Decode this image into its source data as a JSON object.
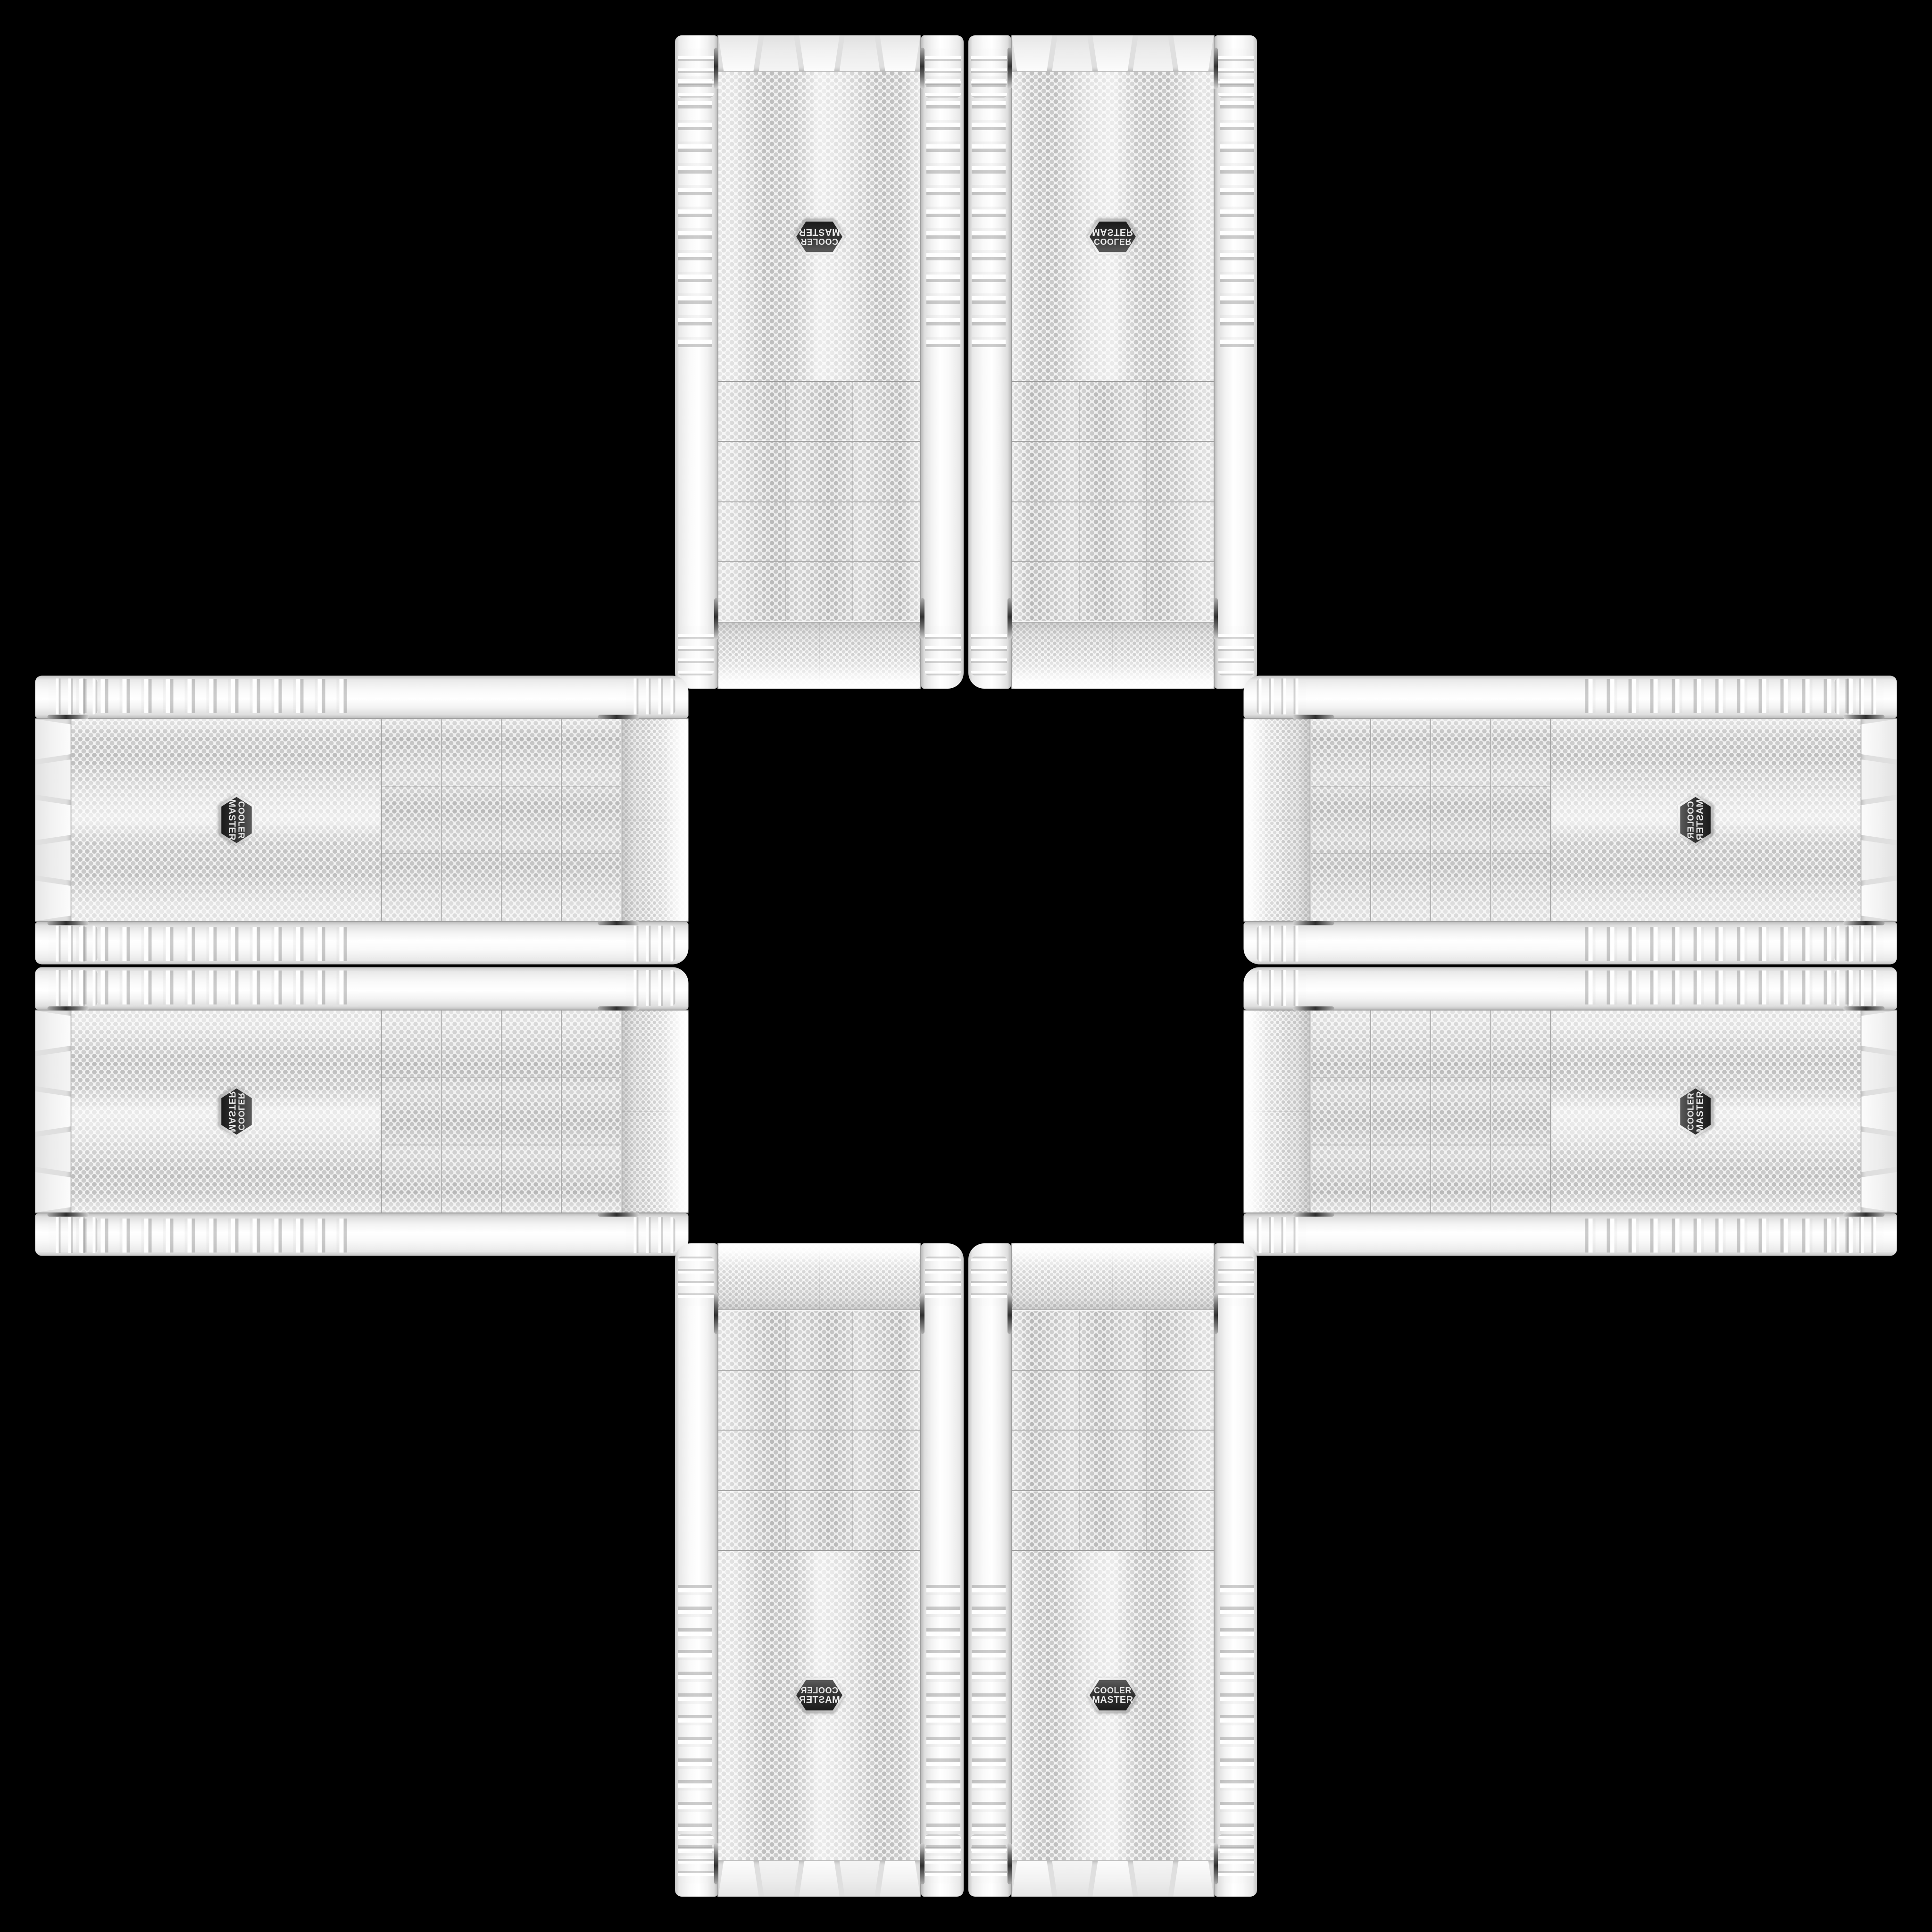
{
  "scene": {
    "background_color": "#000000",
    "description": "Eight white Cooler Master PC case front panels arranged in a plus / cross pattern on a black background",
    "arrangement": "two vertical cases on top, two on bottom, two horizontal cases on the left, two on the right, all mirror copies of one product photo"
  },
  "badge": {
    "line1": "COOLER",
    "line2": "MASTER",
    "face_color": "#2e2e2e",
    "ring_color": "#d6d6d6",
    "text_color": "#e8e8e8"
  },
  "palette": {
    "case_white": "#f4f4f4",
    "mesh_background": "#f1f1f1",
    "mesh_dot": "#c0c0c0",
    "bay_dot": "#b7b7b7",
    "seam_gray": "#a5a5a5",
    "chrome_accent": "#4f4f4f",
    "background": "#000000"
  },
  "tiles": [
    {
      "id": "top-left",
      "orientation": "vertical",
      "flip": "rotated 180°"
    },
    {
      "id": "top-right",
      "orientation": "vertical",
      "flip": "flipped vertically"
    },
    {
      "id": "left-top",
      "orientation": "horizontal",
      "flip": "rotated 90° cw"
    },
    {
      "id": "right-top",
      "orientation": "horizontal",
      "flip": "rotated 90° ccw + flipped"
    },
    {
      "id": "left-bottom",
      "orientation": "horizontal",
      "flip": "rotated 90° cw + flipped"
    },
    {
      "id": "right-bottom",
      "orientation": "horizontal",
      "flip": "rotated 90° ccw"
    },
    {
      "id": "bottom-left",
      "orientation": "vertical",
      "flip": "flipped horizontally"
    },
    {
      "id": "bottom-right",
      "orientation": "vertical",
      "flip": "none"
    }
  ]
}
